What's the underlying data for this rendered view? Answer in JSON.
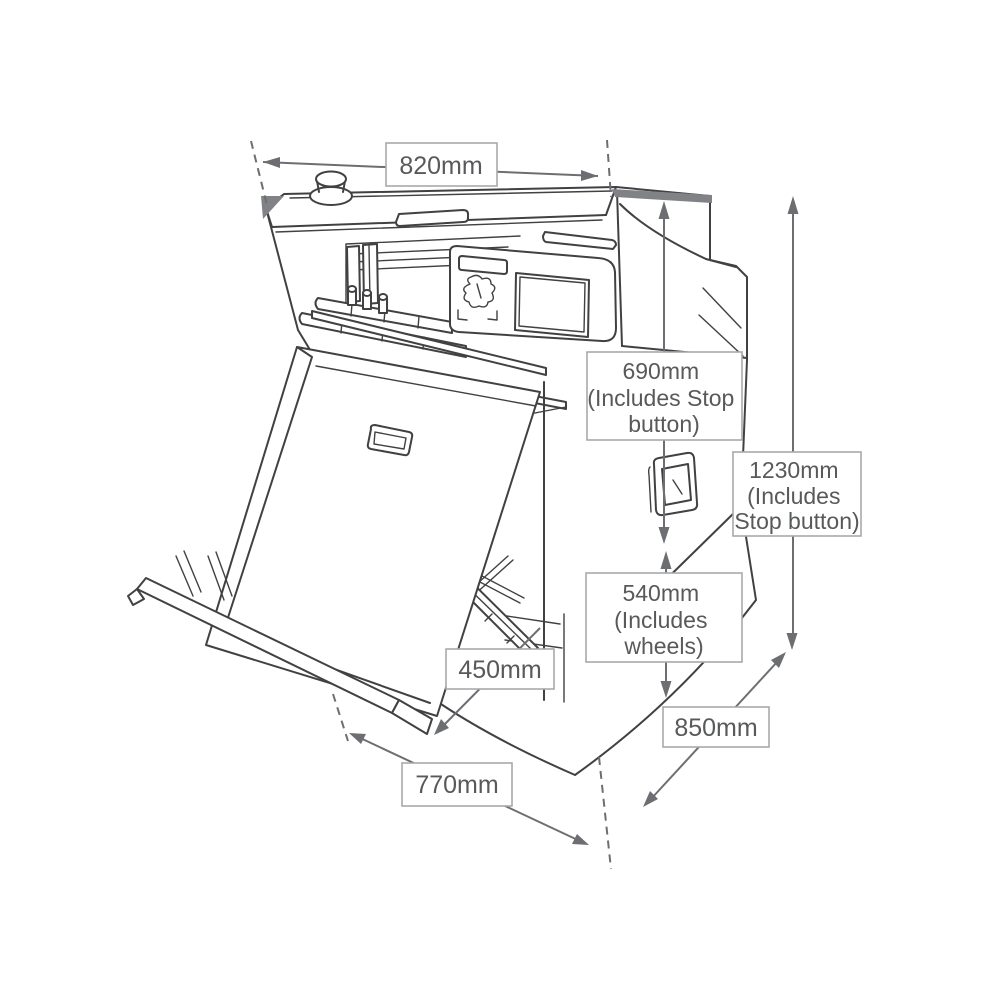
{
  "page": {
    "type": "technical dimension diagram",
    "subject": "Floor-standing paper folding machine (isometric line drawing) with fold-out feed tray, emergency stop button, control panel, power switch and wheeled base",
    "background": "#ffffff"
  },
  "colors": {
    "outline": "#414042",
    "dimension_gray": "#6d6e71",
    "label_text": "#58595b",
    "label_border": "#a7a9ac",
    "label_fill": "#ffffff",
    "accent_fill": "#808285"
  },
  "machine_parts": [
    "emergency-stop-button",
    "top-cover",
    "carry-slot",
    "output-chute",
    "fold-plates",
    "feed-rollers",
    "control-panel",
    "status-display",
    "touch-screen",
    "panel-emblem",
    "power-switch",
    "cabinet",
    "feed-tray",
    "tray-handle",
    "tray-support-rail",
    "tray-legs",
    "support-arms",
    "wheeled-base"
  ],
  "dimension_labels": [
    {
      "id": "width",
      "lines": [
        "820mm"
      ]
    },
    {
      "id": "height-to-top",
      "lines": [
        "690mm",
        "(Includes Stop",
        "button)"
      ]
    },
    {
      "id": "total-height",
      "lines": [
        "1230mm",
        "(Includes",
        "Stop button)"
      ]
    },
    {
      "id": "base-height",
      "lines": [
        "540mm",
        "(Includes",
        "wheels)"
      ]
    },
    {
      "id": "tray-extension",
      "lines": [
        "450mm"
      ]
    },
    {
      "id": "depth",
      "lines": [
        "850mm"
      ]
    },
    {
      "id": "footprint-depth",
      "lines": [
        "770mm"
      ]
    }
  ]
}
